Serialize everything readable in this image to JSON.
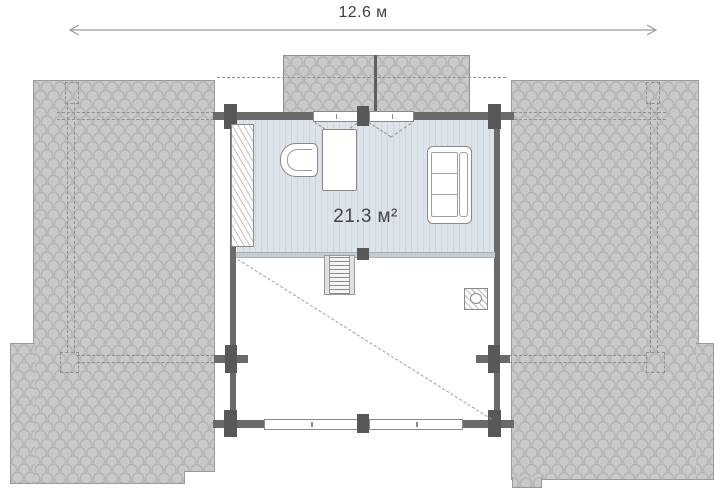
{
  "plan": {
    "dimension_label": "12.6 м",
    "room_area_label": "21.3 м²"
  },
  "colors": {
    "roof_fill": "#c9c9c9",
    "roof_texture_line": "#b4b4b4",
    "roof_line": "#9b9b9b",
    "wall": "#6a6a6a",
    "post": "#585858",
    "floor_fill": "#dde3ea",
    "floor_stripe": "#cdd5de",
    "dashed": "#8f8f8f",
    "furniture_line": "#8a8a8a",
    "text": "#3f3f3f"
  }
}
